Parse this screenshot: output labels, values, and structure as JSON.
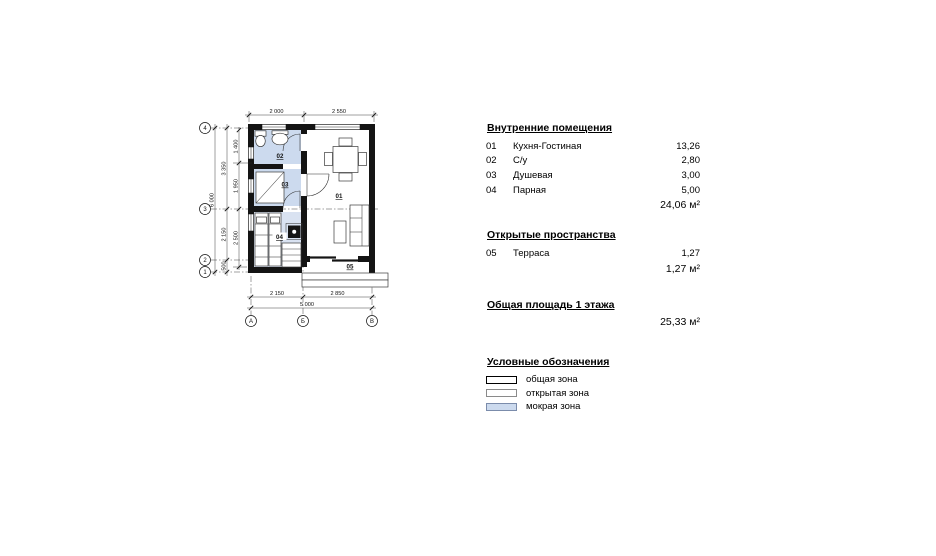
{
  "plan": {
    "grid_rows": [
      "4",
      "3",
      "2",
      "1"
    ],
    "grid_cols": [
      "А",
      "Б",
      "В"
    ],
    "dims": {
      "top_left": "2 000",
      "top_right": "2 550",
      "bottom_left": "2 150",
      "bottom_right": "2 850",
      "bottom_total": "5 000",
      "left_total": "6 000",
      "left_upper": "3 350",
      "left_lower": "2 150",
      "left_bottom": "500",
      "inner_top": "1 400",
      "inner_mid": "1 950",
      "inner_low": "2 500"
    },
    "room_labels": {
      "r01": "01",
      "r02": "02",
      "r03": "03",
      "r04": "04",
      "r05": "05"
    },
    "wet_zone_color": "#ccdaee"
  },
  "panel": {
    "internal": {
      "title": "Внутренние помещения",
      "rows": [
        {
          "num": "01",
          "name": "Кухня-Гостиная",
          "area": "13,26"
        },
        {
          "num": "02",
          "name": "С/у",
          "area": "2,80"
        },
        {
          "num": "03",
          "name": "Душевая",
          "area": "3,00"
        },
        {
          "num": "04",
          "name": "Парная",
          "area": "5,00"
        }
      ],
      "total": "24,06 м²"
    },
    "open": {
      "title": "Открытые пространства",
      "rows": [
        {
          "num": "05",
          "name": "Терраса",
          "area": "1,27"
        }
      ],
      "total": "1,27 м²"
    },
    "grand": {
      "title": "Общая площадь 1 этажа",
      "value": "25,33 м²"
    },
    "legend": {
      "title": "Условные обозначения",
      "items": [
        {
          "label": "общая зона",
          "fill": "#ffffff",
          "border": "#000000"
        },
        {
          "label": "открытая зона",
          "fill": "#ffffff",
          "border": "#8a8a8a"
        },
        {
          "label": "мокрая зона",
          "fill": "#ccdaee",
          "border": "#7b8cab"
        }
      ]
    }
  }
}
